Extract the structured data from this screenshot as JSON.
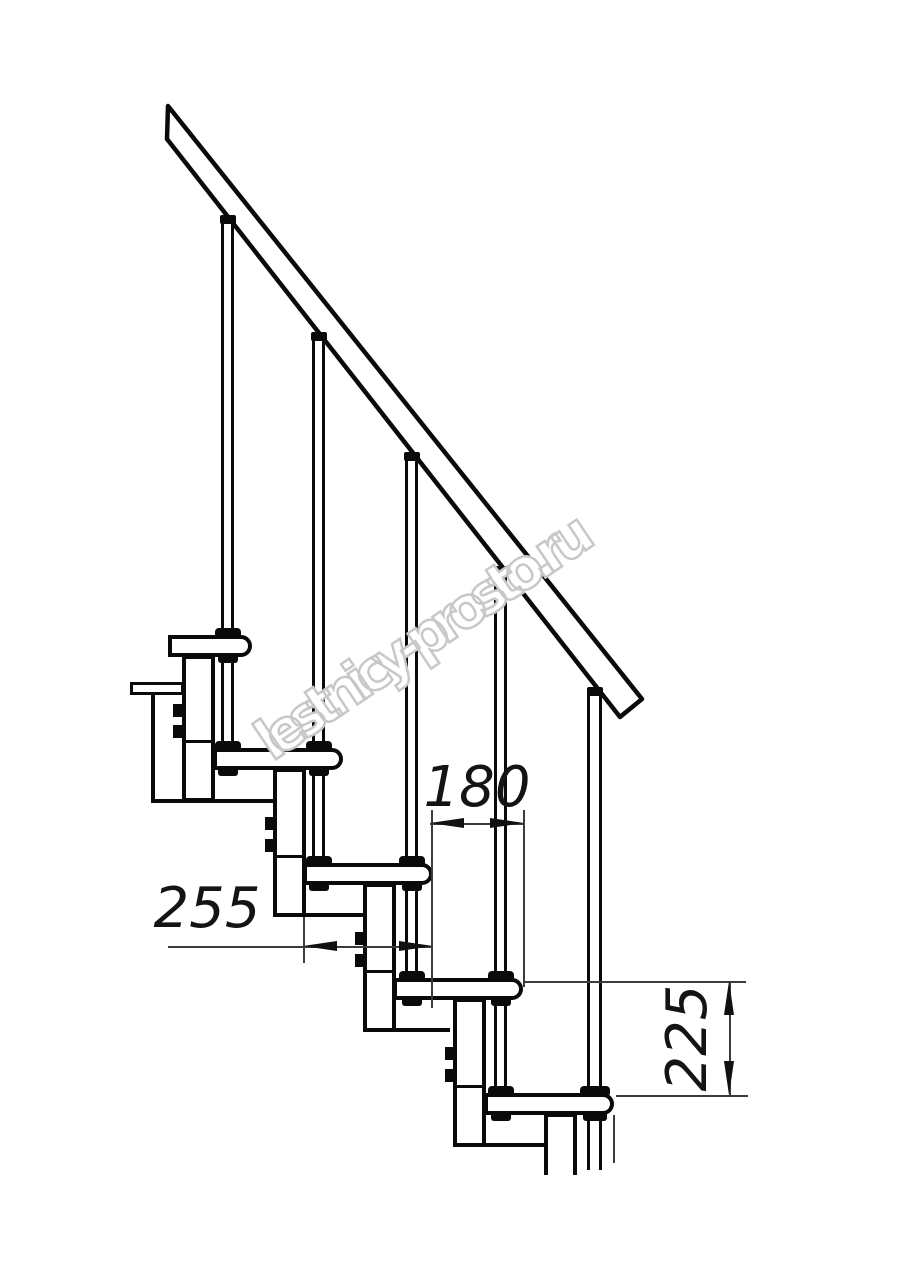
{
  "drawing": {
    "type": "dimensioned technical side-view drawing of a modular staircase",
    "line_color": "#0a0a0a",
    "background": "#ffffff",
    "watermark_color": "#c8c8c8",
    "watermark": "lestnicy-prosto.ru",
    "dimensions": {
      "tread_depth": {
        "label": "255",
        "orientation": "horizontal"
      },
      "step_going": {
        "label": "180",
        "orientation": "horizontal"
      },
      "step_rise": {
        "label": "225",
        "orientation": "vertical"
      }
    },
    "elements": {
      "treads_visible": 5,
      "balusters_visible": 4,
      "end_post": 1,
      "handrail": 1
    }
  }
}
